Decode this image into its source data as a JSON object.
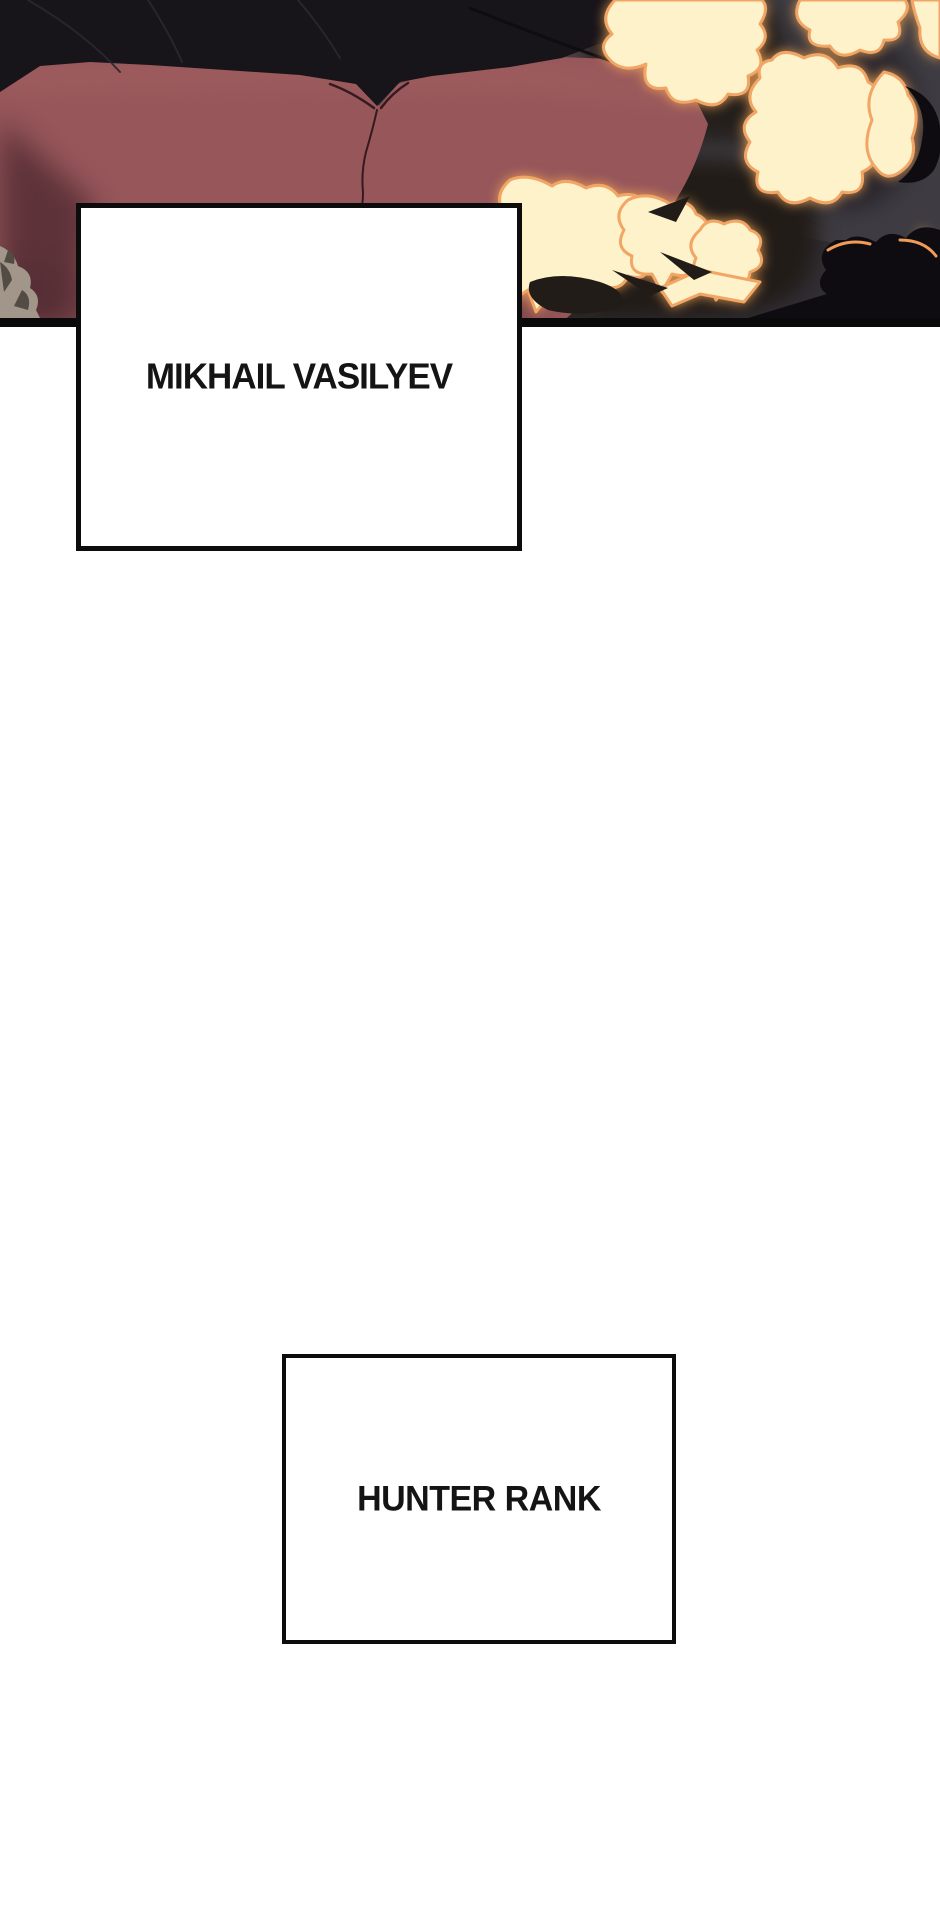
{
  "page": {
    "width": 940,
    "height": 1923,
    "background": "#ffffff"
  },
  "illustration": {
    "description": "Webtoon panel: back view of a dark-haired figure in a maroon jacket, explosion flames and dark smoke on the right, rocks at lower left, black panel border at bottom",
    "colors": {
      "smoke": "#3e3c42",
      "smoke_dark": "#27232a",
      "flame_shadow": "#221c18",
      "silhouette": "#0e0c10",
      "hair": "#17141a",
      "hair_strand": "#2b2730",
      "jacket": "#96565a",
      "jacket_light": "#a36060",
      "jacket_shadow": "#4f2a31",
      "seam": "#341a20",
      "flame_core": "#fdf2c9",
      "flame_rim": "#f2a665",
      "rim_light": "#ef9c58",
      "rock": "#a2968a",
      "rock_shadow": "#524c45",
      "panel_border": "#0a0a0a"
    }
  },
  "captions": [
    {
      "text": "MIKHAIL VASILYEV"
    },
    {
      "text": "HUNTER RANK"
    }
  ]
}
